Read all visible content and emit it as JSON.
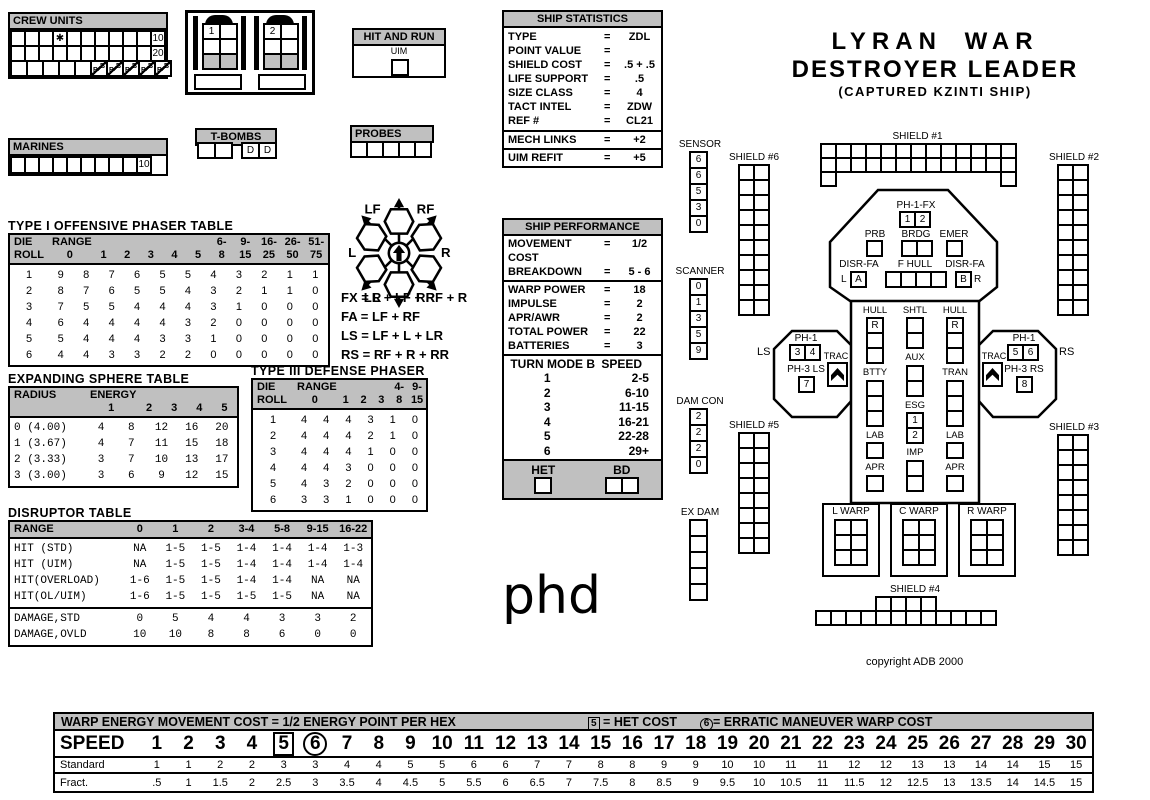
{
  "crew_units": {
    "title": "CREW UNITS",
    "row1_end": "10",
    "row2_end": "20",
    "star": "✱",
    "b_letter": "B"
  },
  "marines": {
    "title": "MARINES",
    "end": "10"
  },
  "shuttle_bay": {
    "numbers": [
      "1",
      "2"
    ]
  },
  "hit_and_run": {
    "title": "HIT AND RUN",
    "box_label": "UIM"
  },
  "t_bombs": {
    "title": "T-BOMBS",
    "d_labels": [
      "D",
      "D"
    ]
  },
  "probes": {
    "title": "PROBES"
  },
  "ship_statistics": {
    "title": "SHIP STATISTICS",
    "rows": [
      {
        "label": "TYPE",
        "value": "ZDL"
      },
      {
        "label": "POINT VALUE",
        "value": ""
      },
      {
        "label": "SHIELD COST",
        "value": ".5 + .5"
      },
      {
        "label": "LIFE SUPPORT",
        "value": ".5"
      },
      {
        "label": "SIZE CLASS",
        "value": "4"
      },
      {
        "label": "TACT INTEL",
        "value": "ZDW"
      },
      {
        "label": "REF #",
        "value": "CL21"
      }
    ],
    "mech": {
      "label": "MECH LINKS",
      "value": "+2"
    },
    "uim": {
      "label": "UIM REFIT",
      "value": "+5"
    }
  },
  "title_block": {
    "line1": "LYRAN WAR",
    "line2": "DESTROYER LEADER",
    "line3": "(CAPTURED KZINTI SHIP)"
  },
  "phaser1": {
    "title": "TYPE I OFFENSIVE PHASER TABLE",
    "heads": [
      [
        "DIE",
        "RANGE",
        "",
        "",
        "",
        "",
        "",
        "6-",
        "9-",
        "16-",
        "26-",
        "51-"
      ],
      [
        "ROLL",
        "0",
        "1",
        "2",
        "3",
        "4",
        "5",
        "8",
        "15",
        "25",
        "50",
        "75"
      ]
    ],
    "rows": [
      [
        "1",
        "9",
        "8",
        "7",
        "6",
        "5",
        "5",
        "4",
        "3",
        "2",
        "1",
        "1"
      ],
      [
        "2",
        "8",
        "7",
        "6",
        "5",
        "5",
        "4",
        "3",
        "2",
        "1",
        "1",
        "0"
      ],
      [
        "3",
        "7",
        "5",
        "5",
        "4",
        "4",
        "4",
        "3",
        "1",
        "0",
        "0",
        "0"
      ],
      [
        "4",
        "6",
        "4",
        "4",
        "4",
        "4",
        "3",
        "2",
        "0",
        "0",
        "0",
        "0"
      ],
      [
        "5",
        "5",
        "4",
        "4",
        "4",
        "3",
        "3",
        "1",
        "0",
        "0",
        "0",
        "0"
      ],
      [
        "6",
        "4",
        "4",
        "3",
        "3",
        "2",
        "2",
        "0",
        "0",
        "0",
        "0",
        "0"
      ]
    ]
  },
  "facing_rose": {
    "lf": "LF",
    "rf": "RF",
    "l": "L",
    "r": "R",
    "lr": "LR",
    "rr": "RR"
  },
  "arc_formulas": [
    "FX = L + LF + RF + R",
    "FA = LF + RF",
    "LS = LF + L + LR",
    "RS = RF + R + RR"
  ],
  "ship_performance": {
    "title": "SHIP PERFORMANCE",
    "group1": [
      {
        "label": "MOVEMENT COST",
        "value": "1/2"
      },
      {
        "label": "BREAKDOWN",
        "value": "5 - 6"
      }
    ],
    "group2": [
      {
        "label": "WARP POWER",
        "value": "18"
      },
      {
        "label": "IMPULSE",
        "value": "2"
      },
      {
        "label": "APR/AWR",
        "value": "2"
      },
      {
        "label": "TOTAL POWER",
        "value": "22"
      },
      {
        "label": "BATTERIES",
        "value": "3"
      }
    ],
    "turn_header_left": "TURN MODE B",
    "turn_header_right": "SPEED",
    "turn_rows": [
      [
        "1",
        "2-5"
      ],
      [
        "2",
        "6-10"
      ],
      [
        "3",
        "11-15"
      ],
      [
        "4",
        "16-21"
      ],
      [
        "5",
        "22-28"
      ],
      [
        "6",
        "29+"
      ]
    ],
    "het_label": "HET",
    "bd_label": "BD"
  },
  "expanding_sphere": {
    "title": "EXPANDING SPHERE TABLE",
    "heads": [
      [
        "RADIUS",
        "ENERGY",
        "",
        "",
        "",
        ""
      ],
      [
        "",
        "1",
        "2",
        "3",
        "4",
        "5"
      ]
    ],
    "rows": [
      [
        "0 (4.00)",
        "4",
        "8",
        "12",
        "16",
        "20"
      ],
      [
        "1 (3.67)",
        "4",
        "7",
        "11",
        "15",
        "18"
      ],
      [
        "2 (3.33)",
        "3",
        "7",
        "10",
        "13",
        "17"
      ],
      [
        "3 (3.00)",
        "3",
        "6",
        "9",
        "12",
        "15"
      ]
    ]
  },
  "phaser3": {
    "title": "TYPE III DEFENSE PHASER",
    "heads": [
      [
        "DIE",
        "RANGE",
        "",
        "",
        "",
        "4-",
        "9-"
      ],
      [
        "ROLL",
        "0",
        "1",
        "2",
        "3",
        "8",
        "15"
      ]
    ],
    "rows": [
      [
        "1",
        "4",
        "4",
        "4",
        "3",
        "1",
        "0"
      ],
      [
        "2",
        "4",
        "4",
        "4",
        "2",
        "1",
        "0"
      ],
      [
        "3",
        "4",
        "4",
        "4",
        "1",
        "0",
        "0"
      ],
      [
        "4",
        "4",
        "4",
        "3",
        "0",
        "0",
        "0"
      ],
      [
        "5",
        "4",
        "3",
        "2",
        "0",
        "0",
        "0"
      ],
      [
        "6",
        "3",
        "3",
        "1",
        "0",
        "0",
        "0"
      ]
    ]
  },
  "disruptor": {
    "title": "DISRUPTOR TABLE",
    "heads": [
      [
        "RANGE",
        "0",
        "1",
        "2",
        "3-4",
        "5-8",
        "9-15",
        "16-22"
      ]
    ],
    "hit_rows": [
      [
        "HIT (STD)",
        "NA",
        "1-5",
        "1-5",
        "1-4",
        "1-4",
        "1-4",
        "1-3"
      ],
      [
        "HIT (UIM)",
        "NA",
        "1-5",
        "1-5",
        "1-4",
        "1-4",
        "1-4",
        "1-4"
      ],
      [
        "HIT(OVERLOAD)",
        "1-6",
        "1-5",
        "1-5",
        "1-4",
        "1-4",
        "NA",
        "NA"
      ],
      [
        "HIT(OL/UIM)",
        "1-6",
        "1-5",
        "1-5",
        "1-5",
        "1-5",
        "NA",
        "NA"
      ]
    ],
    "damage_rows": [
      [
        "DAMAGE,STD",
        "0",
        "5",
        "4",
        "4",
        "3",
        "3",
        "2"
      ],
      [
        "DAMAGE,OVLD",
        "10",
        "10",
        "8",
        "8",
        "6",
        "0",
        "0"
      ]
    ]
  },
  "handwriting": "phd",
  "diagram": {
    "sensor": {
      "label": "SENSOR",
      "values": [
        "6",
        "6",
        "5",
        "3",
        "0"
      ]
    },
    "scanner": {
      "label": "SCANNER",
      "values": [
        "0",
        "1",
        "3",
        "5",
        "9"
      ]
    },
    "dam_con": {
      "label": "DAM CON",
      "values": [
        "2",
        "2",
        "2",
        "0"
      ]
    },
    "ex_dam": {
      "label": "EX DAM"
    },
    "shields": [
      {
        "name": "SHIELD #1"
      },
      {
        "name": "SHIELD #2"
      },
      {
        "name": "SHIELD #3"
      },
      {
        "name": "SHIELD #4"
      },
      {
        "name": "SHIELD #5"
      },
      {
        "name": "SHIELD #6"
      }
    ],
    "octagon": {
      "ph1fx": {
        "label": "PH-1-FX",
        "boxes": [
          "1",
          "2"
        ]
      },
      "prb": "PRB",
      "brdg": "BRDG",
      "emer": "EMER",
      "disr_left": {
        "label": "DISR-FA",
        "letter": "L",
        "boxes": [
          "A"
        ]
      },
      "f_hull": "F HULL",
      "disr_right": {
        "label": "DISR-FA",
        "letter": "R",
        "boxes": [
          "B"
        ]
      }
    },
    "left_wing": {
      "outside": "LS",
      "ph1_label": "PH-1",
      "ph1_boxes": [
        "3",
        "4"
      ],
      "ph3_label": "PH-3 LS",
      "ph3_boxes": [
        "7"
      ],
      "trac": "TRAC"
    },
    "right_wing": {
      "outside": "RS",
      "ph1_label": "PH-1",
      "ph1_boxes": [
        "5",
        "6"
      ],
      "ph3_label": "PH-3 RS",
      "ph3_boxes": [
        "8"
      ],
      "trac": "TRAC"
    },
    "center_cols": [
      {
        "segments": [
          {
            "label": "HULL",
            "boxes": [
              "R",
              "",
              ""
            ]
          },
          {
            "label": "BTTY",
            "boxes": [
              "",
              "",
              ""
            ]
          },
          {
            "label": "LAB",
            "boxes": [
              ""
            ]
          },
          {
            "label": "APR",
            "boxes": [
              ""
            ]
          }
        ]
      },
      {
        "segments": [
          {
            "label": "SHTL",
            "boxes": [
              "",
              ""
            ]
          },
          {
            "label": "AUX",
            "boxes": [
              "",
              ""
            ]
          },
          {
            "label": "ESG",
            "boxes": [
              "1",
              "2"
            ]
          },
          {
            "label": "IMP",
            "boxes": [
              "",
              ""
            ]
          }
        ]
      },
      {
        "segments": [
          {
            "label": "HULL",
            "boxes": [
              "R",
              "",
              ""
            ]
          },
          {
            "label": "TRAN",
            "boxes": [
              "",
              "",
              ""
            ]
          },
          {
            "label": "LAB",
            "boxes": [
              ""
            ]
          },
          {
            "label": "APR",
            "boxes": [
              ""
            ]
          }
        ]
      }
    ],
    "warps": [
      "L WARP",
      "C WARP",
      "R WARP"
    ],
    "copyright": "copyright ADB 2000"
  },
  "speed_chart": {
    "header_main": "WARP ENERGY MOVEMENT COST = 1/2 ENERGY POINT PER HEX",
    "het_note_num": "5",
    "het_note_text": "= HET COST",
    "em_note_num": "6",
    "em_note_text": "= ERRATIC MANEUVER WARP COST",
    "speed_label": "SPEED",
    "standard_label": "Standard",
    "fract_label": "Fract.",
    "speeds": [
      "1",
      "2",
      "3",
      "4",
      "5",
      "6",
      "7",
      "8",
      "9",
      "10",
      "11",
      "12",
      "13",
      "14",
      "15",
      "16",
      "17",
      "18",
      "19",
      "20",
      "21",
      "22",
      "23",
      "24",
      "25",
      "26",
      "27",
      "28",
      "29",
      "30"
    ],
    "standard": [
      "1",
      "1",
      "2",
      "2",
      "3",
      "3",
      "4",
      "4",
      "5",
      "5",
      "6",
      "6",
      "7",
      "7",
      "8",
      "8",
      "9",
      "9",
      "10",
      "10",
      "11",
      "11",
      "12",
      "12",
      "13",
      "13",
      "14",
      "14",
      "15",
      "15"
    ],
    "fract": [
      ".5",
      "1",
      "1.5",
      "2",
      "2.5",
      "3",
      "3.5",
      "4",
      "4.5",
      "5",
      "5.5",
      "6",
      "6.5",
      "7",
      "7.5",
      "8",
      "8.5",
      "9",
      "9.5",
      "10",
      "10.5",
      "11",
      "11.5",
      "12",
      "12.5",
      "13",
      "13.5",
      "14",
      "14.5",
      "15"
    ],
    "boxed_speed": "5",
    "circled_speed": "6"
  }
}
